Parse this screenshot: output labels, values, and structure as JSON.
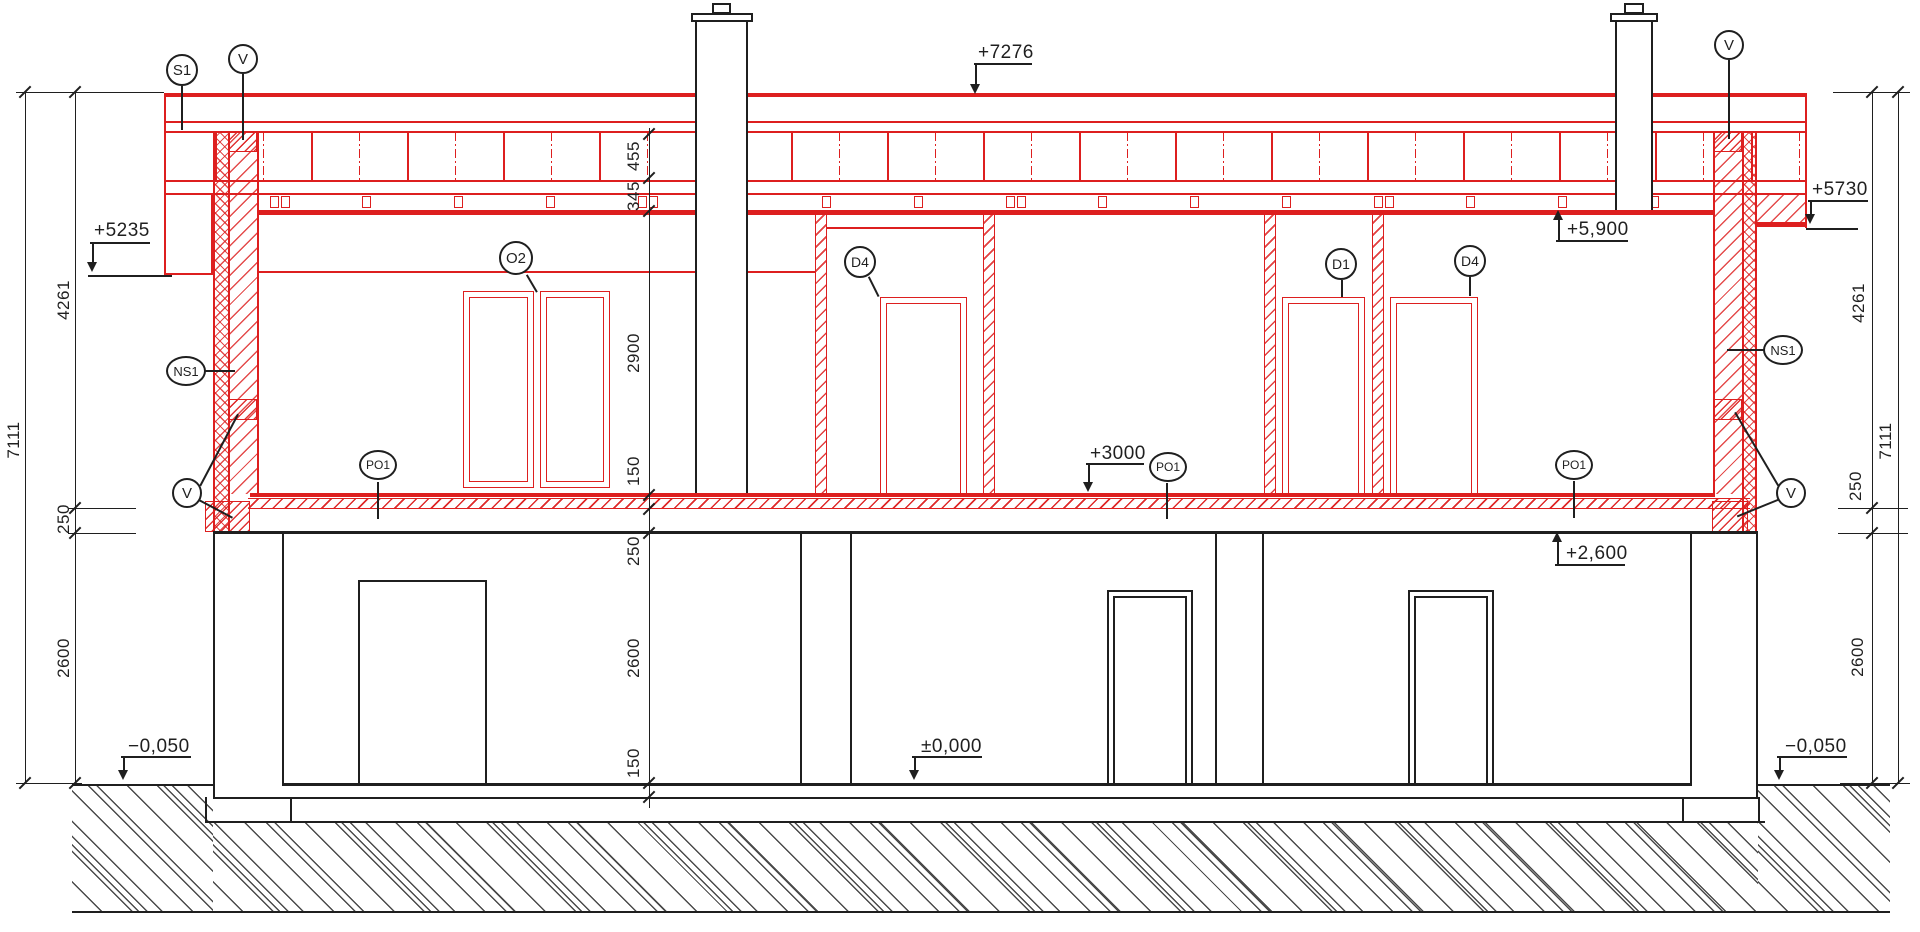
{
  "drawing": {
    "type": "architectural-section",
    "accent_color": "#dd1f1f",
    "line_color": "#1f1f1f"
  },
  "callouts": [
    {
      "label": "S1",
      "cx": 182,
      "cy": 70,
      "rx": 16,
      "ry": 16,
      "fs": 15
    },
    {
      "label": "V",
      "cx": 243,
      "cy": 59,
      "rx": 15,
      "ry": 15,
      "fs": 15
    },
    {
      "label": "V",
      "cx": 1729,
      "cy": 45,
      "rx": 15,
      "ry": 15,
      "fs": 15
    },
    {
      "label": "NS1",
      "cx": 186,
      "cy": 371,
      "rx": 20,
      "ry": 15,
      "fs": 13
    },
    {
      "label": "NS1",
      "cx": 1783,
      "cy": 350,
      "rx": 20,
      "ry": 15,
      "fs": 13
    },
    {
      "label": "V",
      "cx": 187,
      "cy": 493,
      "rx": 15,
      "ry": 15,
      "fs": 15
    },
    {
      "label": "V",
      "cx": 1791,
      "cy": 493,
      "rx": 15,
      "ry": 15,
      "fs": 15
    },
    {
      "label": "O2",
      "cx": 516,
      "cy": 258,
      "rx": 17,
      "ry": 17,
      "fs": 15
    },
    {
      "label": "D4",
      "cx": 860,
      "cy": 262,
      "rx": 16,
      "ry": 16,
      "fs": 14
    },
    {
      "label": "D1",
      "cx": 1341,
      "cy": 264,
      "rx": 16,
      "ry": 16,
      "fs": 14
    },
    {
      "label": "D4",
      "cx": 1470,
      "cy": 261,
      "rx": 16,
      "ry": 16,
      "fs": 14
    },
    {
      "label": "PO1",
      "cx": 378,
      "cy": 465,
      "rx": 19,
      "ry": 15,
      "fs": 12
    },
    {
      "label": "PO1",
      "cx": 1168,
      "cy": 467,
      "rx": 19,
      "ry": 15,
      "fs": 12
    },
    {
      "label": "PO1",
      "cx": 1574,
      "cy": 465,
      "rx": 19,
      "ry": 15,
      "fs": 12
    }
  ],
  "elevation_markers": [
    {
      "label": "+7276",
      "tx": 978,
      "ty": 42,
      "ux": 974,
      "uw": 58,
      "uy": 63,
      "dx": 975,
      "dy1": 63,
      "dy2": 84,
      "ax": 975,
      "ay": 84,
      "dir": "down"
    },
    {
      "label": "+5235",
      "tx": 94,
      "ty": 220,
      "ux": 90,
      "uw": 60,
      "uy": 242,
      "dx": 92,
      "dy1": 242,
      "dy2": 262,
      "ax": 92,
      "ay": 262,
      "dir": "down"
    },
    {
      "label": "+5730",
      "tx": 1812,
      "ty": 179,
      "ux": 1808,
      "uw": 60,
      "uy": 200,
      "dx": 1810,
      "dy1": 200,
      "dy2": 214,
      "ax": 1810,
      "ay": 214,
      "dir": "down"
    },
    {
      "label": "+5,900",
      "tx": 1567,
      "ty": 219,
      "ux": 1556,
      "uw": 72,
      "uy": 240,
      "dx": 1558,
      "dy1": 219,
      "dy2": 240,
      "ax": 1558,
      "ay": 210,
      "dir": "up"
    },
    {
      "label": "+3000",
      "tx": 1090,
      "ty": 443,
      "ux": 1086,
      "uw": 58,
      "uy": 463,
      "dx": 1088,
      "dy1": 463,
      "dy2": 482,
      "ax": 1088,
      "ay": 482,
      "dir": "down"
    },
    {
      "label": "+2,600",
      "tx": 1566,
      "ty": 543,
      "ux": 1555,
      "uw": 70,
      "uy": 564,
      "dx": 1557,
      "dy1": 541,
      "dy2": 564,
      "ax": 1557,
      "ay": 532,
      "dir": "up"
    },
    {
      "label": "±0,000",
      "tx": 921,
      "ty": 736,
      "ux": 912,
      "uw": 70,
      "uy": 756,
      "dx": 914,
      "dy1": 756,
      "dy2": 770,
      "ax": 914,
      "ay": 770,
      "dir": "down"
    },
    {
      "label": "−0,050",
      "tx": 128,
      "ty": 736,
      "ux": 121,
      "uw": 70,
      "uy": 756,
      "dx": 123,
      "dy1": 756,
      "dy2": 770,
      "ax": 123,
      "ay": 770,
      "dir": "down"
    },
    {
      "label": "−0,050",
      "tx": 1785,
      "ty": 736,
      "ux": 1777,
      "uw": 70,
      "uy": 756,
      "dx": 1779,
      "dy1": 756,
      "dy2": 770,
      "ax": 1779,
      "ay": 770,
      "dir": "down"
    }
  ],
  "dimensions": [
    {
      "value": "7111",
      "x": 14,
      "y": 440
    },
    {
      "value": "4261",
      "x": 64,
      "y": 300
    },
    {
      "value": "250",
      "x": 64,
      "y": 519
    },
    {
      "value": "2600",
      "x": 64,
      "y": 658
    },
    {
      "value": "455",
      "x": 634,
      "y": 156
    },
    {
      "value": "345",
      "x": 634,
      "y": 196
    },
    {
      "value": "2900",
      "x": 634,
      "y": 353
    },
    {
      "value": "150",
      "x": 634,
      "y": 471
    },
    {
      "value": "250",
      "x": 634,
      "y": 551
    },
    {
      "value": "2600",
      "x": 634,
      "y": 658
    },
    {
      "value": "150",
      "x": 634,
      "y": 763
    },
    {
      "value": "4261",
      "x": 1859,
      "y": 303
    },
    {
      "value": "250",
      "x": 1856,
      "y": 486
    },
    {
      "value": "2600",
      "x": 1858,
      "y": 657
    },
    {
      "value": "7111",
      "x": 1886,
      "y": 441
    }
  ]
}
